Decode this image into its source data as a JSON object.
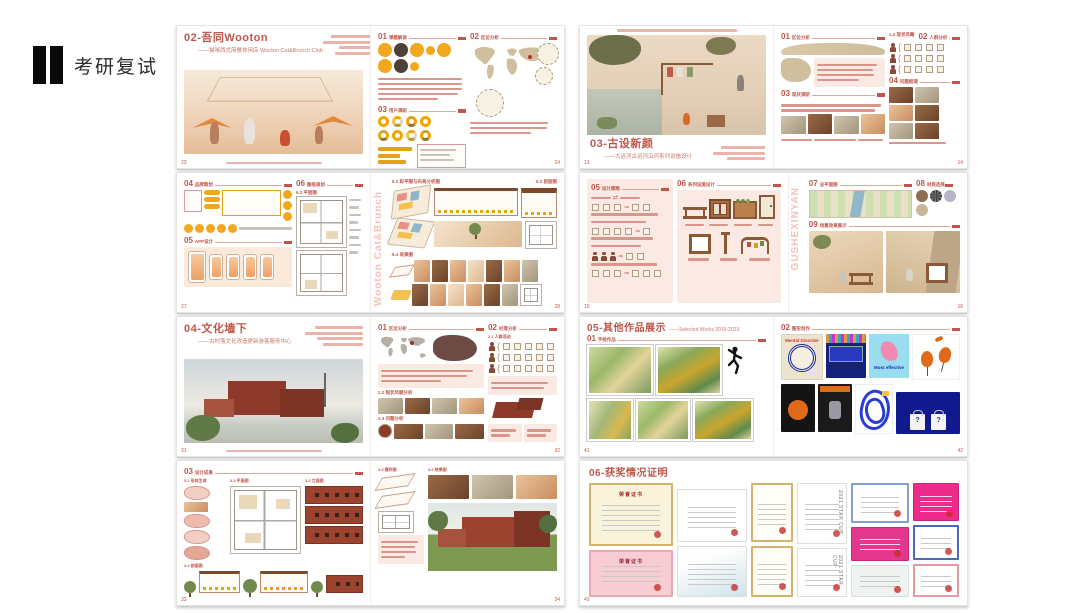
{
  "logo": {
    "label": "考研复试"
  },
  "cards": {
    "l1": {
      "title": "02-吾同Wooton",
      "subtitle": "——猫咪西式简餐休闲店 Wooton Cat&Brunch Club",
      "sec1n": "01",
      "sec1t": "课题解读",
      "sec2n": "02",
      "sec2t": "区位分析",
      "sec3n": "03",
      "sec3t": "用户调研",
      "page_l": "23",
      "page_r": "24"
    },
    "l2": {
      "sec4n": "04",
      "sec4t": "品牌策划",
      "sec5n": "05",
      "sec5t": "APP设计",
      "sec6n": "06",
      "sec6t": "图纸规划",
      "s61": "6.1 平面图",
      "s62": "6.2 彩平图与布局分析图",
      "s63": "6.3 剖面图",
      "s64": "6.4 效果图",
      "watermark": "Wooton Cat&Brunch",
      "page_l": "27",
      "page_r": "28"
    },
    "l3": {
      "title": "04-文化墙下",
      "subtitle": "——古村落文化改造更新游客服务中心",
      "sec1n": "01",
      "sec1t": "区位分析",
      "sec2n": "02",
      "sec2t": "村落分析",
      "s21": "2.1 人群活动",
      "s22": "2.2 现状风貌分析",
      "s23": "2.3 问题分析",
      "page_l": "31",
      "page_r": "32"
    },
    "l4": {
      "headn": "03",
      "headt": "设计成果",
      "s31": "3.1 形体生成",
      "s32": "3.2 平面图",
      "s33": "3.3 立面图",
      "s34": "3.4 剖面图",
      "s35": "3.5 爆炸图",
      "s36": "3.6 效果图",
      "page_l": "33",
      "page_r": "34"
    },
    "r1": {
      "title": "03-古设新颜",
      "subtitle": "——大运河古运河沿河系列设施设计",
      "sec1n": "01",
      "sec1t": "区位分析",
      "s12": "1.2 现状鸟瞰",
      "sec2n": "02",
      "sec2t": "人群分析",
      "sec3n": "03",
      "sec3t": "现状调研",
      "sec4n": "04",
      "sec4t": "问题梳理",
      "page_l": "13",
      "page_r": "14"
    },
    "r2": {
      "sec5n": "05",
      "sec5t": "设计策略",
      "sec6n": "06",
      "sec6t": "系列设施设计",
      "sec7n": "07",
      "sec7t": "总平面图",
      "sec8n": "08",
      "sec8t": "材质选择",
      "sec9n": "09",
      "sec9t": "场景效果展示",
      "watermark": "GUSHEXINYAN",
      "page_l": "15",
      "page_r": "16"
    },
    "r3": {
      "title": "05-其他作品展示",
      "subtitle": "——Selected Works 2019-2023",
      "sec1n": "01",
      "sec1t": "手绘作品",
      "sec2n": "02",
      "sec2t": "图形创作",
      "poster_mental": "Mental Disorder",
      "poster_effective": "Most effective",
      "tote_mark": "?",
      "page_l": "41",
      "page_r": "42"
    },
    "r4": {
      "title": "06-获奖情况证明",
      "cert_title_gold": "荣誉证书",
      "cert_title_pink": "荣誉证书",
      "starcup": "2021 STAR CUP",
      "page_l": "43"
    }
  },
  "colors": {
    "accent": "#c0564b",
    "yellow": "#f2a71c",
    "brick": "#9c4330",
    "pink": "#f3b7ad"
  }
}
